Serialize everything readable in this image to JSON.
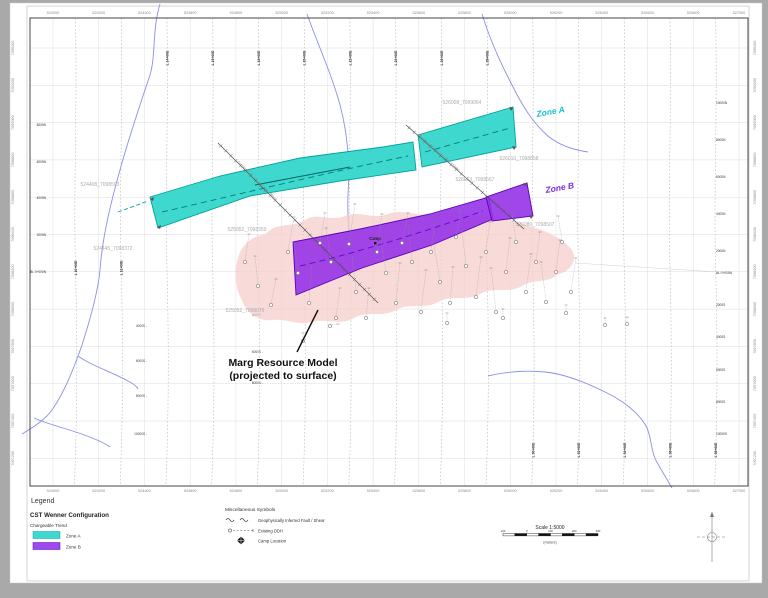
{
  "map": {
    "top_axis_labels": [
      "524000",
      "524200",
      "524400",
      "524600",
      "524800",
      "525000",
      "525200",
      "525400",
      "525600",
      "525800",
      "526000",
      "526200",
      "526400",
      "526600",
      "526800",
      "527000"
    ],
    "bottom_axis_labels": [
      "524000",
      "524200",
      "524400",
      "524600",
      "524800",
      "525000",
      "525200",
      "525400",
      "525600",
      "525800",
      "526000",
      "526200",
      "526400",
      "526600",
      "526800",
      "527000"
    ],
    "left_axis_labels": [
      "7099400",
      "7099200",
      "7099000",
      "7098800",
      "7098600",
      "7098400",
      "7098200",
      "7098000",
      "7097800",
      "7097600",
      "7097400",
      "7097200"
    ],
    "right_axis_labels": [
      "7099400",
      "7099200",
      "7099000",
      "7098800",
      "7098600",
      "7098400",
      "7098200",
      "7098000",
      "7097800",
      "7097600",
      "7097400",
      "7097200"
    ],
    "inner_left_station_labels": [
      {
        "text": "8000N",
        "y": 126
      },
      {
        "text": "6000N",
        "y": 163
      },
      {
        "text": "4000N",
        "y": 199
      },
      {
        "text": "2000N",
        "y": 236
      },
      {
        "text": "BL 0+000N",
        "y": 273
      }
    ],
    "inner_right_station_labels": [
      {
        "text": "10000N",
        "y": 104
      },
      {
        "text": "8000N",
        "y": 141
      },
      {
        "text": "6000N",
        "y": 178
      },
      {
        "text": "4000N",
        "y": 215
      },
      {
        "text": "2000N",
        "y": 252
      },
      {
        "text": "BL 0+000N",
        "y": 274
      },
      {
        "text": "2000S",
        "y": 306
      },
      {
        "text": "4000S",
        "y": 338
      },
      {
        "text": "6000S",
        "y": 371
      },
      {
        "text": "8000S",
        "y": 403
      },
      {
        "text": "10000S",
        "y": 435
      }
    ],
    "mid_station_columns": [
      {
        "x": 147,
        "items": [
          {
            "text": "4000S",
            "y": 327
          },
          {
            "text": "6000S",
            "y": 362
          },
          {
            "text": "8000S",
            "y": 397
          },
          {
            "text": "10000S",
            "y": 435
          }
        ]
      },
      {
        "x": 263,
        "items": [
          {
            "text": "4000S",
            "y": 316
          },
          {
            "text": "6000S",
            "y": 353
          },
          {
            "text": "8000S",
            "y": 384
          }
        ]
      }
    ],
    "survey_line_labels": [
      "L 10+00E",
      "L 12+00E",
      "L 14+00E",
      "L 16+00E",
      "L 18+00E",
      "L 20+00E",
      "L 22+00E",
      "L 24+00E",
      "L 26+00E",
      "L 28+00E",
      "L 30+00E",
      "L 32+00E",
      "L 34+00E",
      "L 36+00E",
      "L 38+00E"
    ],
    "point_labels": [
      {
        "text": "524408_7098593",
        "x": 100,
        "y": 186
      },
      {
        "text": "524445_7098372",
        "x": 113,
        "y": 250
      },
      {
        "text": "525052_7098359",
        "x": 247,
        "y": 231
      },
      {
        "text": "525052_7098075",
        "x": 245,
        "y": 312
      },
      {
        "text": "526008_7099064",
        "x": 462,
        "y": 104
      },
      {
        "text": "526010_7098858",
        "x": 519,
        "y": 160
      },
      {
        "text": "526063_7098667",
        "x": 475,
        "y": 181
      },
      {
        "text": "526080_7098507",
        "x": 535,
        "y": 226
      }
    ],
    "zone_a_label": "Zone A",
    "zone_b_label": "Zone B",
    "camp_label": "Camp",
    "fault_text": "Geophysically Inferred Fault / Shear",
    "annotation": {
      "line1": "Marg Resource Model",
      "line2": "(projected to surface)"
    }
  },
  "legend": {
    "title": "Legend",
    "section1_title": "CST Wenner Configuration",
    "section1_sub": "Chargeable Trend",
    "zone_items": [
      {
        "label": "Zone A",
        "color": "#3FD8CE"
      },
      {
        "label": "Zone B",
        "color": "#9B4BF0"
      }
    ],
    "misc_title": "Miscellaneous Symbols",
    "misc_items": [
      {
        "label": "Geophysically Inferred Fault / Shear",
        "icon": "fault-squiggle-icon"
      },
      {
        "label": "Existing DDH",
        "icon": "ddh-circle-icon"
      },
      {
        "label": "Camp Location",
        "icon": "camp-diamond-icon"
      }
    ]
  },
  "scale_bar": {
    "title": "Scale 1:5000",
    "ticks": [
      "100",
      "0",
      "100",
      "200",
      "300"
    ],
    "units": "(meters)"
  },
  "colors": {
    "zone_a_fill": "#3FD8CE",
    "zone_a_edge": "#009E96",
    "zone_a_label": "#17C4CB",
    "zone_b_fill": "#9633E8",
    "zone_b_edge": "#5B00B8",
    "zone_b_label": "#7A2BE8",
    "resource_pink": "#EFA0A0",
    "stream_blue": "#8B8FE8",
    "grey_label": "#ACACAC"
  },
  "ddh_collars": [
    [
      245,
      262,
      4,
      28
    ],
    [
      258,
      286,
      -3,
      30
    ],
    [
      271,
      305,
      5,
      26
    ],
    [
      288,
      252,
      6,
      35
    ],
    [
      298,
      273,
      -4,
      30
    ],
    [
      309,
      303,
      3,
      38
    ],
    [
      320,
      243,
      5,
      30
    ],
    [
      331,
      262,
      -5,
      34
    ],
    [
      336,
      318,
      4,
      30
    ],
    [
      349,
      244,
      6,
      40
    ],
    [
      356,
      292,
      -4,
      36
    ],
    [
      366,
      318,
      3,
      30
    ],
    [
      377,
      252,
      5,
      38
    ],
    [
      386,
      273,
      -5,
      33
    ],
    [
      396,
      303,
      4,
      40
    ],
    [
      402,
      243,
      6,
      30
    ],
    [
      412,
      262,
      -4,
      36
    ],
    [
      421,
      312,
      5,
      42
    ],
    [
      431,
      252,
      4,
      30
    ],
    [
      440,
      282,
      -6,
      38
    ],
    [
      450,
      303,
      3,
      36
    ],
    [
      456,
      237,
      5,
      28
    ],
    [
      466,
      266,
      -4,
      34
    ],
    [
      476,
      297,
      5,
      40
    ],
    [
      486,
      252,
      4,
      30
    ],
    [
      496,
      312,
      -5,
      44
    ],
    [
      506,
      272,
      4,
      34
    ],
    [
      516,
      242,
      -4,
      28
    ],
    [
      526,
      292,
      5,
      38
    ],
    [
      536,
      262,
      4,
      30
    ],
    [
      546,
      302,
      -5,
      40
    ],
    [
      556,
      272,
      4,
      32
    ],
    [
      562,
      242,
      -4,
      26
    ],
    [
      571,
      292,
      5,
      34
    ],
    [
      303,
      341,
      0,
      8
    ],
    [
      330,
      326,
      8,
      2
    ],
    [
      447,
      323,
      0,
      10
    ],
    [
      503,
      318,
      0,
      9
    ],
    [
      566,
      313,
      0,
      8
    ],
    [
      605,
      325,
      0,
      7
    ],
    [
      627,
      324,
      0,
      7
    ]
  ]
}
